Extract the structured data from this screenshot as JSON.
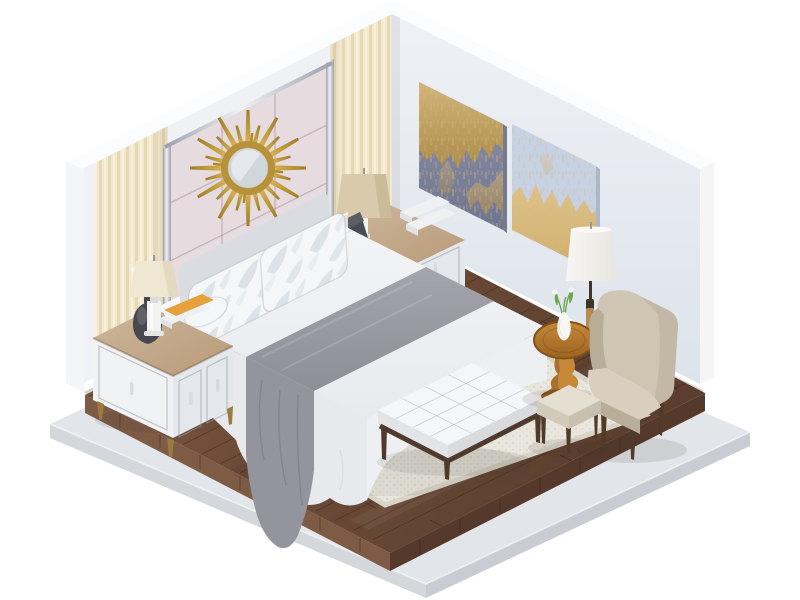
{
  "scene": {
    "description": "Isometric 3D render of a modern bedroom: white walls, cream curtains, gold sunburst mirror over a mauve upholstered headboard panel, two gold-and-blue abstract paintings, king bed with white duvet and gray throw, white nightstands with lamps, tufted bench, beige wingback armchair with ottoman, round wooden side table, floor lamp, cream rug on dark wood floor over a concrete platform",
    "objects": [
      {
        "id": "left-wall",
        "label": "Back-left wall with curtains and headboard panel"
      },
      {
        "id": "right-wall",
        "label": "Back-right wall with two abstract paintings"
      },
      {
        "id": "curtains",
        "label": "Cream pleated curtain panels"
      },
      {
        "id": "headboard-panel",
        "label": "Mauve upholstered wall panel with chrome trim"
      },
      {
        "id": "sunburst-mirror",
        "label": "Gold sunburst wall mirror"
      },
      {
        "id": "painting-1",
        "label": "Abstract painting, navy and gold"
      },
      {
        "id": "painting-2",
        "label": "Abstract painting, light blue and gold"
      },
      {
        "id": "bed",
        "label": "King bed with white duvet, gray throw, leaf-pattern pillows"
      },
      {
        "id": "nightstand-left",
        "label": "White nightstand with lamp, orchid vase and books"
      },
      {
        "id": "nightstand-right",
        "label": "White nightstand with tan lamp, books and telephone"
      },
      {
        "id": "bench",
        "label": "Tufted white bench with dark wood legs"
      },
      {
        "id": "rug",
        "label": "Cream woven area rug"
      },
      {
        "id": "wood-floor",
        "label": "Dark walnut plank floor"
      },
      {
        "id": "platform",
        "label": "Light concrete base platform"
      },
      {
        "id": "floor-lamp",
        "label": "Floor lamp with white drum shade"
      },
      {
        "id": "side-table",
        "label": "Round pedestal side table with flower vase"
      },
      {
        "id": "armchair",
        "label": "Beige wingback armchair"
      },
      {
        "id": "ottoman",
        "label": "Small upholstered ottoman"
      }
    ]
  },
  "colors": {
    "background": "#ffffff",
    "wall_left": "#f0f1f4",
    "wall_right_top": "#eef1f5",
    "wall_right_bottom": "#dde3eb",
    "wall_top_cap": "#fbfcfd",
    "wall_edge": "#f4f5f7",
    "curtain_base": "#f2e8cf",
    "curtain_shade": "#e5d8b5",
    "curtain_highlight": "#f8f0da",
    "headboard_panel": "#e6dce0",
    "panel_seam": "#c9bcc3",
    "chrome_light": "#f0f2f5",
    "chrome_dark": "#9aa1ab",
    "mirror_gold_light": "#e0bd5c",
    "mirror_gold_dark": "#a07c25",
    "mirror_ring": "#b8923a",
    "mirror_glass": "#cfd7db",
    "painting1_top": "#8f94aa",
    "painting1_bottom": "#6f7490",
    "painting1_gold": "#d7b877",
    "painting2_base": "#c7d1e4",
    "painting2_gold": "#cfab62",
    "headboard": "#e9ebee",
    "pillow_gray": "#d9dde2",
    "pillow_white": "#f4f6f8",
    "pillow_leaf": "#dce3e8",
    "mattress_light": "#f3f4f6",
    "mattress_dark": "#e8eaee",
    "bed_side": "#e7e9ed",
    "bed_side_front": "#edeff2",
    "throw_light": "#a4a4ac",
    "throw_dark": "#8e8e96",
    "drape_gray": "#94949c",
    "nightstand_body": "#f1f2f4",
    "nightstand_side": "#e4e7eb",
    "glass_top_light": "#cdb79c",
    "glass_top_dark": "#b89a78",
    "brass_leg": "#9c7b42",
    "vase_dark": "#474750",
    "book_orange": "#e6a03c",
    "book_white": "#eef0f2",
    "lamp_cream": "#efe7d2",
    "lamp_tan": "#d9caab",
    "lamp_shade_white": "#f7f6f3",
    "lamp_shade_white_dim": "#e7e5df",
    "lamp_body": "#f2f2f0",
    "bench_wood": "#503a2b",
    "wood_light": "#7a563f",
    "wood_dark": "#5b3e2e",
    "wood_edge_left": "#7d5b45",
    "wood_edge_right": "#55392b",
    "slab_top": "#e2e5e9",
    "slab_side_left": "#d4d7dc",
    "slab_side_right": "#c9cdd3",
    "rug": "#e9e6de",
    "rug_edge": "#d8d4c8",
    "table_top_light": "#c68938",
    "table_top_dark": "#9c6322",
    "table_wood_dark": "#84511c",
    "chair_beige": "#cfc5b3",
    "chair_shade": "#b8ad99",
    "chair_seat": "#d8cfbe",
    "stool_cushion": "#e5dfd2",
    "stool_side": "#d2c9b8",
    "plant_green": "#6da84e",
    "pole_dark": "#3e362c",
    "pole_wood": "#b68a50",
    "phone_dark": "#4b4b52"
  }
}
